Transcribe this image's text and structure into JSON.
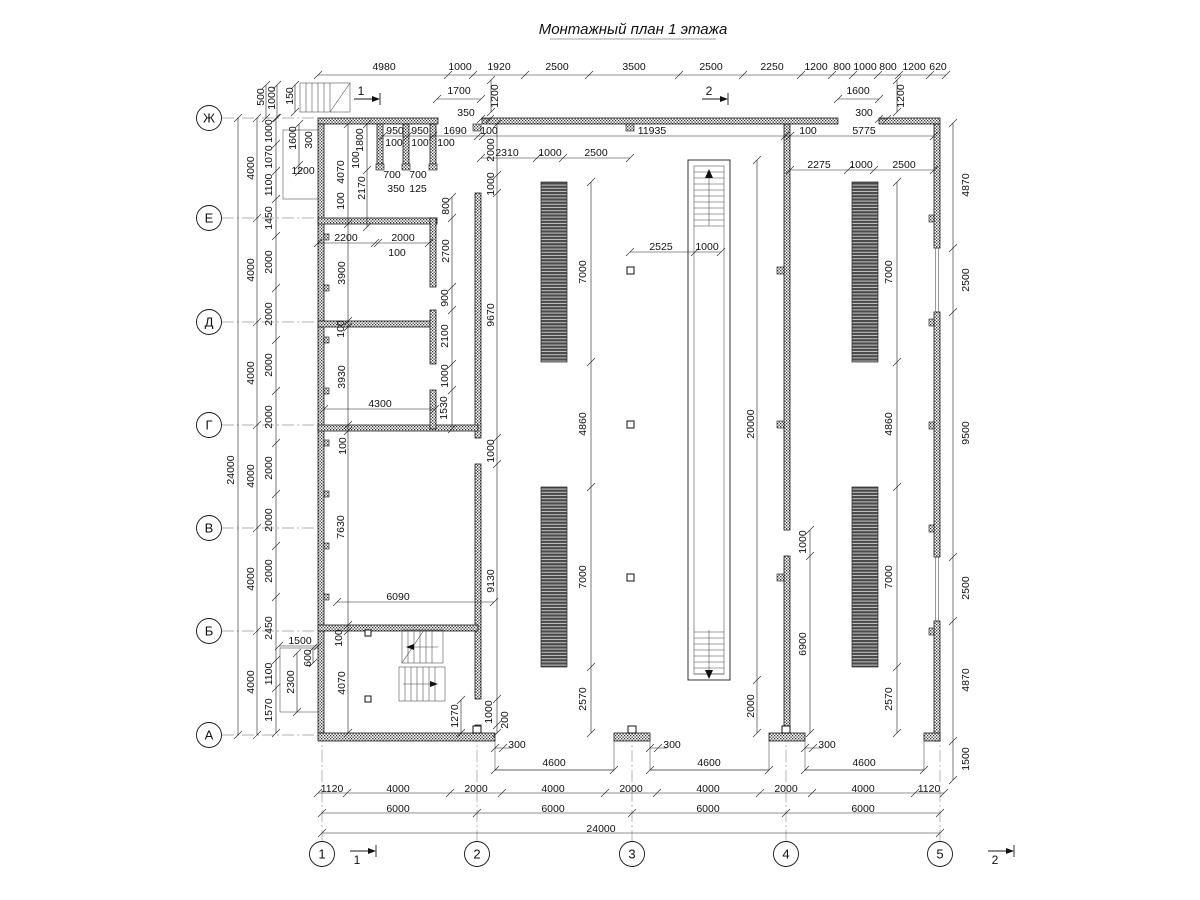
{
  "title": {
    "text": "Монтажный план 1 этажа"
  },
  "axes": {
    "rows": [
      {
        "label": "Ж",
        "y": 118
      },
      {
        "label": "Е",
        "y": 218
      },
      {
        "label": "Д",
        "y": 322
      },
      {
        "label": "Г",
        "y": 425
      },
      {
        "label": "В",
        "y": 528
      },
      {
        "label": "Б",
        "y": 631
      },
      {
        "label": "А",
        "y": 735
      }
    ],
    "rows_cx": 209,
    "cols": [
      {
        "label": "1",
        "x": 322
      },
      {
        "label": "2",
        "x": 477
      },
      {
        "label": "3",
        "x": 632
      },
      {
        "label": "4",
        "x": 786
      },
      {
        "label": "5",
        "x": 940
      }
    ],
    "cols_cy": 854,
    "radius": 12.5
  },
  "section_marks": [
    {
      "label": "1"
    },
    {
      "label": "2"
    },
    {
      "label": "1"
    },
    {
      "label": "2"
    }
  ],
  "colors": {
    "line": "#1a1a1a",
    "dim_text": "#111111",
    "axis_gray": "#999999",
    "rack_dark": "#4a4a4a"
  },
  "dims": [
    {
      "t": "4980",
      "x": 384,
      "y": 67
    },
    {
      "t": "1000",
      "x": 460,
      "y": 67
    },
    {
      "t": "1920",
      "x": 499,
      "y": 67
    },
    {
      "t": "2500",
      "x": 557,
      "y": 67
    },
    {
      "t": "3500",
      "x": 634,
      "y": 67
    },
    {
      "t": "2500",
      "x": 711,
      "y": 67
    },
    {
      "t": "2250",
      "x": 772,
      "y": 67
    },
    {
      "t": "1200",
      "x": 816,
      "y": 67
    },
    {
      "t": "800",
      "x": 842,
      "y": 67
    },
    {
      "t": "1000",
      "x": 865,
      "y": 67
    },
    {
      "t": "800",
      "x": 888,
      "y": 67
    },
    {
      "t": "1200",
      "x": 914,
      "y": 67
    },
    {
      "t": "620",
      "x": 938,
      "y": 67
    },
    {
      "t": "1700",
      "x": 459,
      "y": 91
    },
    {
      "t": "350",
      "x": 466,
      "y": 113
    },
    {
      "t": "1200",
      "x": 495,
      "y": 96,
      "v": 1
    },
    {
      "t": "1600",
      "x": 858,
      "y": 91
    },
    {
      "t": "300",
      "x": 864,
      "y": 113
    },
    {
      "t": "1200",
      "x": 901,
      "y": 96,
      "v": 1
    },
    {
      "t": "950",
      "x": 395,
      "y": 131
    },
    {
      "t": "950",
      "x": 420,
      "y": 131
    },
    {
      "t": "1690",
      "x": 455,
      "y": 131
    },
    {
      "t": "100",
      "x": 489,
      "y": 131
    },
    {
      "t": "11935",
      "x": 652,
      "y": 131
    },
    {
      "t": "100",
      "x": 808,
      "y": 131
    },
    {
      "t": "5775",
      "x": 864,
      "y": 131
    },
    {
      "t": "100",
      "x": 394,
      "y": 143
    },
    {
      "t": "100",
      "x": 420,
      "y": 143
    },
    {
      "t": "100",
      "x": 446,
      "y": 143
    },
    {
      "t": "2310",
      "x": 507,
      "y": 153
    },
    {
      "t": "1000",
      "x": 550,
      "y": 153
    },
    {
      "t": "2500",
      "x": 596,
      "y": 153
    },
    {
      "t": "2275",
      "x": 819,
      "y": 165
    },
    {
      "t": "1000",
      "x": 861,
      "y": 165
    },
    {
      "t": "2500",
      "x": 904,
      "y": 165
    },
    {
      "t": "24000",
      "x": 231,
      "y": 470,
      "v": 1
    },
    {
      "t": "4000",
      "x": 251,
      "y": 168,
      "v": 1
    },
    {
      "t": "4000",
      "x": 251,
      "y": 270,
      "v": 1
    },
    {
      "t": "4000",
      "x": 251,
      "y": 373,
      "v": 1
    },
    {
      "t": "4000",
      "x": 251,
      "y": 476,
      "v": 1
    },
    {
      "t": "4000",
      "x": 251,
      "y": 579,
      "v": 1
    },
    {
      "t": "4000",
      "x": 251,
      "y": 682,
      "v": 1
    },
    {
      "t": "1000",
      "x": 269,
      "y": 131,
      "v": 1
    },
    {
      "t": "1070",
      "x": 269,
      "y": 157,
      "v": 1
    },
    {
      "t": "1100",
      "x": 269,
      "y": 185,
      "v": 1
    },
    {
      "t": "1450",
      "x": 269,
      "y": 218,
      "v": 1
    },
    {
      "t": "2000",
      "x": 269,
      "y": 262,
      "v": 1
    },
    {
      "t": "2000",
      "x": 269,
      "y": 314,
      "v": 1
    },
    {
      "t": "2000",
      "x": 269,
      "y": 365,
      "v": 1
    },
    {
      "t": "2000",
      "x": 269,
      "y": 417,
      "v": 1
    },
    {
      "t": "2000",
      "x": 269,
      "y": 468,
      "v": 1
    },
    {
      "t": "2000",
      "x": 269,
      "y": 520,
      "v": 1
    },
    {
      "t": "2000",
      "x": 269,
      "y": 571,
      "v": 1
    },
    {
      "t": "2450",
      "x": 269,
      "y": 628,
      "v": 1
    },
    {
      "t": "1100",
      "x": 269,
      "y": 674,
      "v": 1
    },
    {
      "t": "1570",
      "x": 269,
      "y": 710,
      "v": 1
    },
    {
      "t": "500",
      "x": 261,
      "y": 97,
      "v": 1
    },
    {
      "t": "1000",
      "x": 272,
      "y": 98,
      "v": 1
    },
    {
      "t": "150",
      "x": 290,
      "y": 96,
      "v": 1
    },
    {
      "t": "1600",
      "x": 293,
      "y": 138,
      "v": 1
    },
    {
      "t": "300",
      "x": 309,
      "y": 140,
      "v": 1
    },
    {
      "t": "1200",
      "x": 303,
      "y": 171
    },
    {
      "t": "1800",
      "x": 360,
      "y": 140,
      "v": 1
    },
    {
      "t": "4070",
      "x": 341,
      "y": 172,
      "v": 1
    },
    {
      "t": "2170",
      "x": 362,
      "y": 188,
      "v": 1
    },
    {
      "t": "100",
      "x": 356,
      "y": 160,
      "v": 1
    },
    {
      "t": "100",
      "x": 341,
      "y": 201,
      "v": 1
    },
    {
      "t": "700",
      "x": 392,
      "y": 175
    },
    {
      "t": "700",
      "x": 418,
      "y": 175
    },
    {
      "t": "350",
      "x": 396,
      "y": 189
    },
    {
      "t": "125",
      "x": 418,
      "y": 189
    },
    {
      "t": "800",
      "x": 446,
      "y": 206,
      "v": 1
    },
    {
      "t": "2000",
      "x": 491,
      "y": 150,
      "v": 1
    },
    {
      "t": "1000",
      "x": 491,
      "y": 184,
      "v": 1
    },
    {
      "t": "2200",
      "x": 346,
      "y": 238
    },
    {
      "t": "2000",
      "x": 403,
      "y": 238
    },
    {
      "t": "100",
      "x": 397,
      "y": 253
    },
    {
      "t": "2700",
      "x": 446,
      "y": 251,
      "v": 1
    },
    {
      "t": "900",
      "x": 445,
      "y": 298,
      "v": 1
    },
    {
      "t": "2100",
      "x": 445,
      "y": 336,
      "v": 1
    },
    {
      "t": "1000",
      "x": 445,
      "y": 376,
      "v": 1
    },
    {
      "t": "1530",
      "x": 444,
      "y": 408,
      "v": 1
    },
    {
      "t": "3900",
      "x": 342,
      "y": 273,
      "v": 1
    },
    {
      "t": "100",
      "x": 341,
      "y": 329,
      "v": 1
    },
    {
      "t": "3930",
      "x": 342,
      "y": 377,
      "v": 1
    },
    {
      "t": "4300",
      "x": 380,
      "y": 404
    },
    {
      "t": "9670",
      "x": 491,
      "y": 315,
      "v": 1
    },
    {
      "t": "1000",
      "x": 491,
      "y": 451,
      "v": 1
    },
    {
      "t": "7630",
      "x": 341,
      "y": 527,
      "v": 1
    },
    {
      "t": "100",
      "x": 343,
      "y": 446,
      "v": 1
    },
    {
      "t": "6090",
      "x": 398,
      "y": 597
    },
    {
      "t": "9130",
      "x": 491,
      "y": 581,
      "v": 1
    },
    {
      "t": "100",
      "x": 339,
      "y": 638,
      "v": 1
    },
    {
      "t": "4070",
      "x": 342,
      "y": 683,
      "v": 1
    },
    {
      "t": "1270",
      "x": 455,
      "y": 716,
      "v": 1
    },
    {
      "t": "1000",
      "x": 489,
      "y": 712,
      "v": 1
    },
    {
      "t": "200",
      "x": 505,
      "y": 720,
      "v": 1
    },
    {
      "t": "1500",
      "x": 300,
      "y": 641
    },
    {
      "t": "600",
      "x": 308,
      "y": 658,
      "v": 1
    },
    {
      "t": "2300",
      "x": 291,
      "y": 682,
      "v": 1
    },
    {
      "t": "2525",
      "x": 661,
      "y": 247
    },
    {
      "t": "1000",
      "x": 707,
      "y": 247
    },
    {
      "t": "7000",
      "x": 583,
      "y": 272,
      "v": 1
    },
    {
      "t": "4860",
      "x": 583,
      "y": 424,
      "v": 1
    },
    {
      "t": "7000",
      "x": 583,
      "y": 577,
      "v": 1
    },
    {
      "t": "2570",
      "x": 583,
      "y": 699,
      "v": 1
    },
    {
      "t": "20000",
      "x": 751,
      "y": 424,
      "v": 1
    },
    {
      "t": "2000",
      "x": 751,
      "y": 706,
      "v": 1
    },
    {
      "t": "1000",
      "x": 803,
      "y": 542,
      "v": 1
    },
    {
      "t": "6900",
      "x": 803,
      "y": 644,
      "v": 1
    },
    {
      "t": "7000",
      "x": 889,
      "y": 272,
      "v": 1
    },
    {
      "t": "4860",
      "x": 889,
      "y": 424,
      "v": 1
    },
    {
      "t": "7000",
      "x": 889,
      "y": 577,
      "v": 1
    },
    {
      "t": "2570",
      "x": 889,
      "y": 699,
      "v": 1
    },
    {
      "t": "4870",
      "x": 966,
      "y": 185,
      "v": 1
    },
    {
      "t": "2500",
      "x": 966,
      "y": 280,
      "v": 1
    },
    {
      "t": "9500",
      "x": 966,
      "y": 433,
      "v": 1
    },
    {
      "t": "2500",
      "x": 966,
      "y": 588,
      "v": 1
    },
    {
      "t": "4870",
      "x": 966,
      "y": 680,
      "v": 1
    },
    {
      "t": "1500",
      "x": 966,
      "y": 759,
      "v": 1
    },
    {
      "t": "300",
      "x": 517,
      "y": 745
    },
    {
      "t": "300",
      "x": 672,
      "y": 745
    },
    {
      "t": "300",
      "x": 827,
      "y": 745
    },
    {
      "t": "4600",
      "x": 554,
      "y": 763
    },
    {
      "t": "4600",
      "x": 709,
      "y": 763
    },
    {
      "t": "4600",
      "x": 864,
      "y": 763
    },
    {
      "t": "1120",
      "x": 332,
      "y": 789
    },
    {
      "t": "4000",
      "x": 398,
      "y": 789
    },
    {
      "t": "2000",
      "x": 476,
      "y": 789
    },
    {
      "t": "4000",
      "x": 553,
      "y": 789
    },
    {
      "t": "2000",
      "x": 631,
      "y": 789
    },
    {
      "t": "4000",
      "x": 708,
      "y": 789
    },
    {
      "t": "2000",
      "x": 786,
      "y": 789
    },
    {
      "t": "4000",
      "x": 863,
      "y": 789
    },
    {
      "t": "1120",
      "x": 929,
      "y": 789
    },
    {
      "t": "6000",
      "x": 398,
      "y": 809
    },
    {
      "t": "6000",
      "x": 553,
      "y": 809
    },
    {
      "t": "6000",
      "x": 708,
      "y": 809
    },
    {
      "t": "6000",
      "x": 863,
      "y": 809
    },
    {
      "t": "24000",
      "x": 601,
      "y": 829
    }
  ]
}
